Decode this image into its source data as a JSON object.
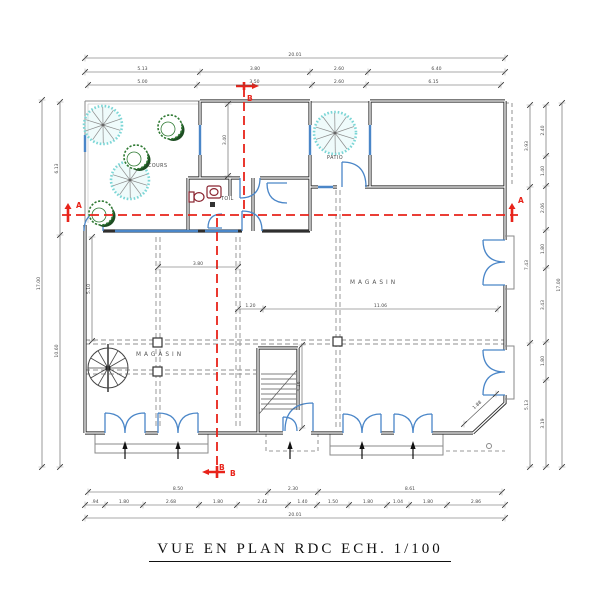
{
  "title": "VUE EN PLAN RDC ECH. 1/100",
  "colors": {
    "wall": "#2f2f2f",
    "opening_blue": "#4a86c8",
    "section_red": "#e8231a",
    "tree_cyan": "#7cd6d6",
    "bush_green": "#2f7a33",
    "dimension_text": "#4a4a4a"
  },
  "rooms": {
    "cours": "COURS",
    "patio": "PATIO",
    "toilet": "TOIL",
    "magasin_left": "MAGASIN",
    "magasin_right": "MAGASIN"
  },
  "sections": {
    "a": "A",
    "b": "B"
  },
  "dimensions": {
    "top": {
      "total": [
        "20.01"
      ],
      "row2": [
        "5.13",
        "3.80",
        "2.60",
        "6.40"
      ],
      "row3": [
        "5.00",
        "3.50",
        "2.60",
        "6.15"
      ]
    },
    "bottom": {
      "row1": [
        "8.50",
        "2.30",
        "8.61"
      ],
      "row2": [
        ".94",
        "1.80",
        "2.68",
        "1.80",
        "2.42",
        "1.40",
        "1.50",
        "1.80",
        "1.04",
        "1.80",
        "2.86"
      ],
      "total": [
        "20.01"
      ]
    },
    "left": {
      "total": [
        "17.00"
      ],
      "inner": [
        "6.13",
        "10.60"
      ]
    },
    "right": {
      "inner": [
        "3.93",
        "7.43",
        "5.13"
      ],
      "middle": [
        "2.40",
        "1.40",
        "2.06",
        "1.80",
        "3.43",
        "1.80",
        "3.19"
      ],
      "total": [
        "17.00"
      ]
    },
    "interior": {
      "top_room": [
        "3.40"
      ],
      "bay": [
        "3.80"
      ],
      "span_small": [
        "1.20"
      ],
      "span_main": [
        "11.06"
      ],
      "left_room": [
        "5.10"
      ],
      "stair": [
        "4.16"
      ],
      "corner": [
        "1.88"
      ]
    }
  }
}
